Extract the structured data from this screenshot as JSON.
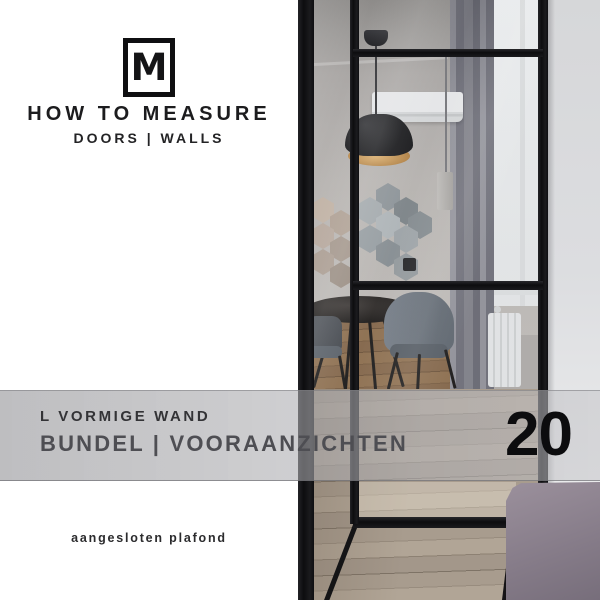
{
  "brand": {
    "logo_letter": "M",
    "title": "HOW TO MEASURE",
    "subtitle": "DOORS | WALLS"
  },
  "banner": {
    "line1": "L VORMIGE WAND",
    "line2": "BUNDEL | VOORAANZICHTEN",
    "number": "20"
  },
  "footer": {
    "note": "aangesloten plafond"
  },
  "photo": {
    "objects": [
      "black steel framed glass partition wall",
      "black pendant lamp with gold interior",
      "air conditioner",
      "hexagon wall tiles",
      "round dining table with grey chairs",
      "grey curtain",
      "window",
      "white radiator",
      "wood plank floor",
      "mauve bed corner"
    ]
  },
  "colors": {
    "frame_black": "#141416",
    "banner_grey": "#bdbdbf",
    "lamp_gold": "#c49556",
    "bed_mauve": "#8d8390",
    "floor_taupe": "#a3978a",
    "near_wall_grey": "#d9dadc",
    "hex_beige": "#b4a496",
    "hex_grey": "#9aa1a5",
    "text_dark": "#1d1d1f"
  }
}
